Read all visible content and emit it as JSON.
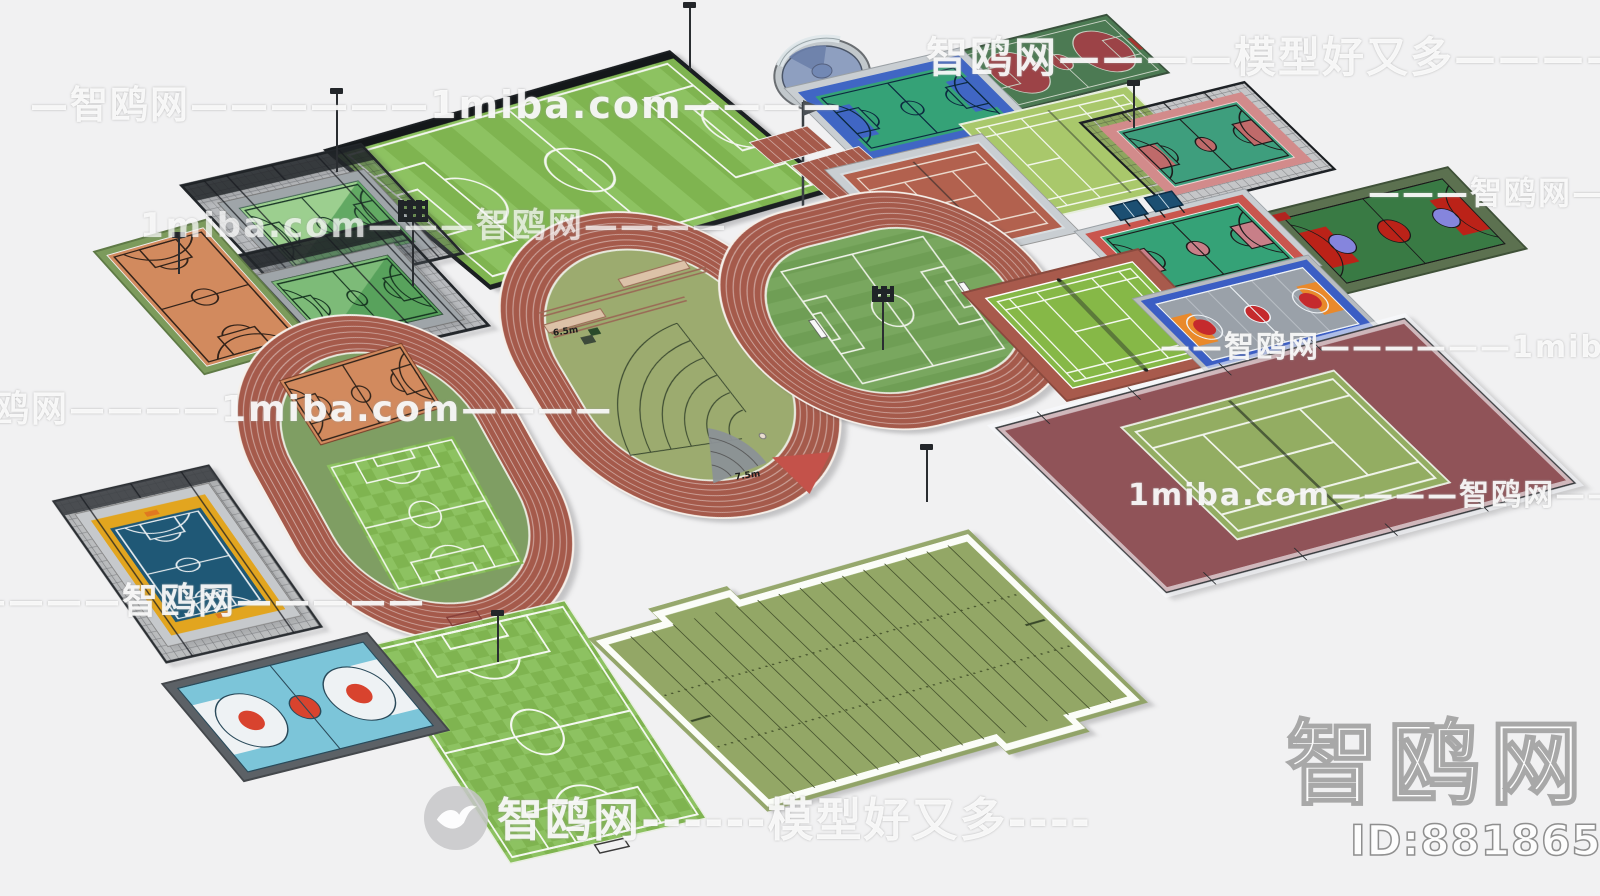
{
  "watermarks": {
    "top_left": "—智鸥网——————1miba.com————",
    "top_right": "智鸥网————模型好又多————",
    "upper_left2": "1miba.com———智鸥网————",
    "right_mid": "———智鸥网———",
    "right_lower": "——智鸥网——————1miba.com",
    "left_mid": "智鸥网————1miba.com————",
    "center_right": "1miba.com————智鸥网———",
    "bottom_left": "————智鸥网—————",
    "bottom_center": "智鸥网------模型好又多----",
    "logo_large": "智鸥网",
    "model_id": "ID:881865988"
  },
  "labels": {
    "runway_a": "6.5m",
    "runway_b": "7.5m"
  },
  "colors": {
    "bg": "#f1f1f2",
    "track-red": "#a55a4b",
    "infield-left": "#7f9e63",
    "infield-mid": "#9cab6f",
    "infield-right": "#6f9e55",
    "turf-a": "#7fb450",
    "turf-b": "#8dc261",
    "fence-dark": "#1c2022",
    "orange-court": "#d28a5e",
    "court-border-green": "#7c9b5c",
    "court-green": "#35a277",
    "blue-frame": "#4066c4",
    "surround-gray": "#c9ced2",
    "tennis-brick": "#b2614e",
    "badminton-light": "#a9c86b",
    "court-darkgreen": "#4c7a53",
    "maroon-circle": "#9c4347",
    "pink-surround": "#d28b8b",
    "court-green2": "#3e9e7d",
    "key-dustyred": "#bf6a6a",
    "olive-surround": "#5c7150",
    "bright-red": "#bb2218",
    "blue-half": "#8585dd",
    "red-surround": "#c9564e",
    "key-pink": "#c87f88",
    "blue-frame2": "#3b5ec4",
    "floor-gray": "#9aa1a9",
    "key-orange": "#e9892b",
    "red-accent": "#c52a2d",
    "red-accent2": "#d8432e",
    "brick-border": "#a85a4c",
    "badminton-green": "#86b847",
    "cage-blue": "#1f5876",
    "cage-yellow": "#e2a51f",
    "lightblue-court": "#7cc5d9",
    "border-darkgray": "#5c6166",
    "maroon-ground": "#8c4a50",
    "sand-green": "#93ad62",
    "football-turf": "#93a766",
    "cage-green-light": "#9ccf8f",
    "cage-green-dark": "#58a25c",
    "pool-water": "#8e9fc0",
    "pool-rim": "#c2c8cc"
  },
  "facilities": [
    "round-pool",
    "basketball-court-darkgreen-top",
    "stadium-soccer-field",
    "basketball-court-blue-frame",
    "flag-pole",
    "sprint-straight-track",
    "badminton-court-light",
    "caged-basketball-court-right",
    "tennis-court-red",
    "caged-basketball-courts-pair",
    "running-track-field-events",
    "running-track-soccer",
    "basketball-court-darkgreen-right",
    "basketball-court-green-red",
    "table-tennis-tables",
    "basketball-court-orange",
    "badminton-court-brick",
    "basketball-court-gray-blue",
    "running-track-basketball-soccer",
    "fenced-tennis-court",
    "caged-basketball-court-yellow-blue",
    "soccer-field-plain",
    "basketball-court-lightblue",
    "american-football-field"
  ]
}
